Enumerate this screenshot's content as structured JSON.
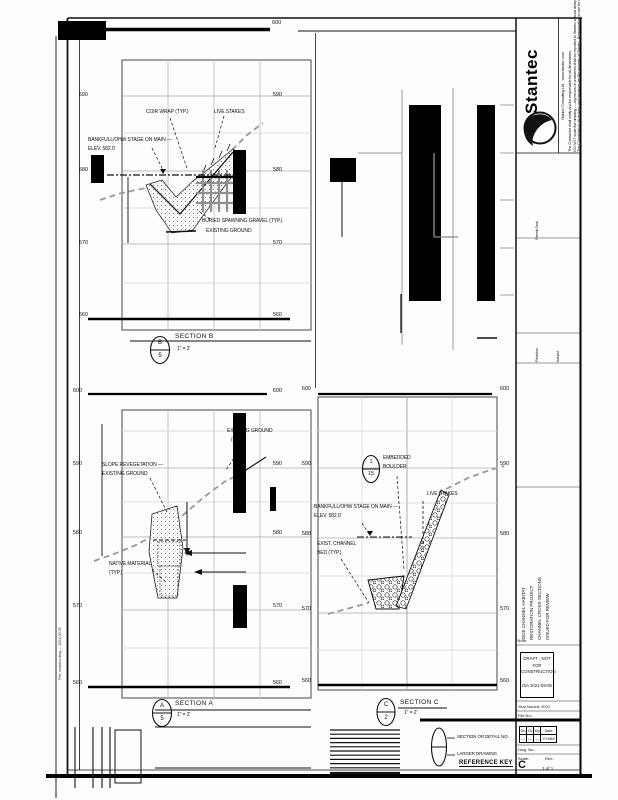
{
  "top": {
    "elev": "600"
  },
  "sec_b": {
    "elev_left": [
      "590",
      "580",
      "570",
      "560"
    ],
    "elev_right": [
      "590",
      "580",
      "570",
      "560"
    ],
    "lbl_coir": "COIR WRAP (TYP.)",
    "lbl_stakes": "LIVE STAKES",
    "lbl_bankfull1": "BANKFULL/OHW STAGE ON MAIN —",
    "lbl_bankfull2": "ELEV. 582.0'",
    "lbl_gravel1": "BURIED SPAWNING GRAVEL (TYP.)",
    "lbl_gravel2": "EXISTING GROUND",
    "callout_top": "B",
    "callout_bottom": "5",
    "title": "SECTION B",
    "scale": "1\" = 2'"
  },
  "sec_a": {
    "elev_left": [
      "600",
      "590",
      "580",
      "570",
      "560"
    ],
    "elev_right": [
      "600",
      "590",
      "580",
      "570",
      "560"
    ],
    "lbl_slope1": "SLOPE REVEGETATION —",
    "lbl_slope2": "EXISTING GROUND",
    "lbl_exist1": "EXISTING GROUND",
    "lbl_exist2": "(TYP.)",
    "lbl_native1": "NATIVE MATERIAL",
    "lbl_native2": "(TYP.)",
    "callout_top": "A",
    "callout_bottom": "5",
    "title": "SECTION A",
    "scale": "1\" = 2'"
  },
  "sec_c": {
    "elev_left": [
      "600",
      "590",
      "580",
      "570",
      "560"
    ],
    "elev_right": [
      "600",
      "590",
      "580",
      "570",
      "560"
    ],
    "boulder_top": "1",
    "boulder_bottom": "15",
    "lbl_emb1": "EMBEDDED",
    "lbl_emb2": "BOULDER",
    "lbl_stakes": "LIVE STAKES",
    "lbl_bankfull1": "BANKFULL/OHW STAGE ON MAIN —",
    "lbl_bankfull2": "ELEV. 582.0'",
    "lbl_bed1": "EXIST. CHANNEL",
    "lbl_bed2": "BED (TYP.)",
    "callout_top": "C",
    "callout_bottom": "2",
    "title": "SECTION C",
    "scale": "1\" = 2'"
  },
  "ref_key": {
    "line1": "SECTION OR DETAIL NO.",
    "line2": "LARGER DRAWING",
    "title": "REFERENCE KEY"
  },
  "titleblock": {
    "brand": "Stantec",
    "address": "Stantec Consulting Ltd. · www.stantec.com",
    "legal1": "The Contractor shall verify and be responsible for all dimensions.",
    "legal2": "DO NOT scale the drawing — any errors or omissions shall be reported to Stantec without delay.",
    "legal3": "The Copyrights to all designs and drawings are the property of Stantec. Reproduction or use for any purpose other than that authorized by Stantec is forbidden.",
    "field1": "Permit-Seal",
    "field2": "Revision",
    "field3": "Issued",
    "proj1": "SIDE CHANNEL HABITAT",
    "proj2": "RESTORATION PROJECT",
    "proj3": "CHANNEL CROSS SECTIONS",
    "proj4": "ISSUED FOR REVIEW",
    "note": "Note:",
    "draft1": "DRAFT - NOT FOR",
    "draft2": "CONSTRUCTION",
    "draft3": "ISA 2021-09-05",
    "year_row": "Year Issued: 2021",
    "file_row": "File No.:",
    "tbl_h": [
      "Dn",
      "Ck",
      "Dg",
      "Date"
    ],
    "tbl_r": [
      "—",
      "—",
      "—",
      "YY.MM"
    ],
    "dwg_row": "Dwg. No.:",
    "scale_row": "Scale:",
    "rev_row": "Rev.:",
    "sheet_letter": "C",
    "sheet_of": "1 of 1"
  },
  "margin": {
    "left_note": "Plot: sections.dwg — 2021-09-05"
  }
}
